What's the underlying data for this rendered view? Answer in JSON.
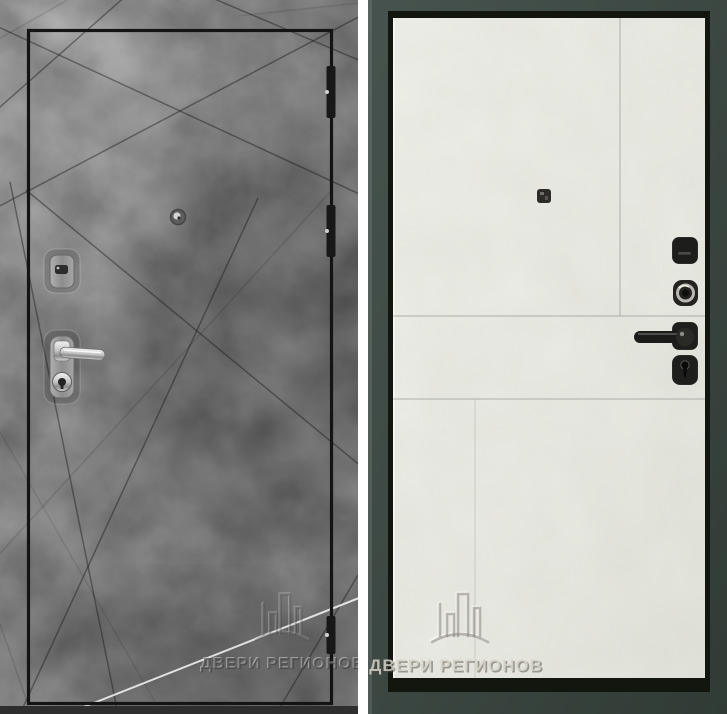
{
  "watermark": {
    "text": "ДВЕРИ РЕГИОНОВ",
    "logo": "buildings-arc-logo"
  },
  "colors": {
    "exterior_concrete": "#828282",
    "exterior_concrete_dark": "#686868",
    "interior_leaf": "#ecede6",
    "door_frame_green": "#3c4843",
    "outline_black": "#141414",
    "hardware_chrome": "#c9c9c9",
    "hardware_black": "#1c1c1a",
    "background": "#ffffff"
  },
  "left_door": {
    "hinge_count": "3",
    "hardware": [
      "keyhole-escutcheon",
      "lever-handle",
      "cylinder-lock",
      "peephole"
    ]
  },
  "right_door": {
    "hardware": [
      "thumbturn-lock",
      "decorative-keyhole",
      "lever-handle",
      "cylinder-lock",
      "peephole"
    ]
  }
}
